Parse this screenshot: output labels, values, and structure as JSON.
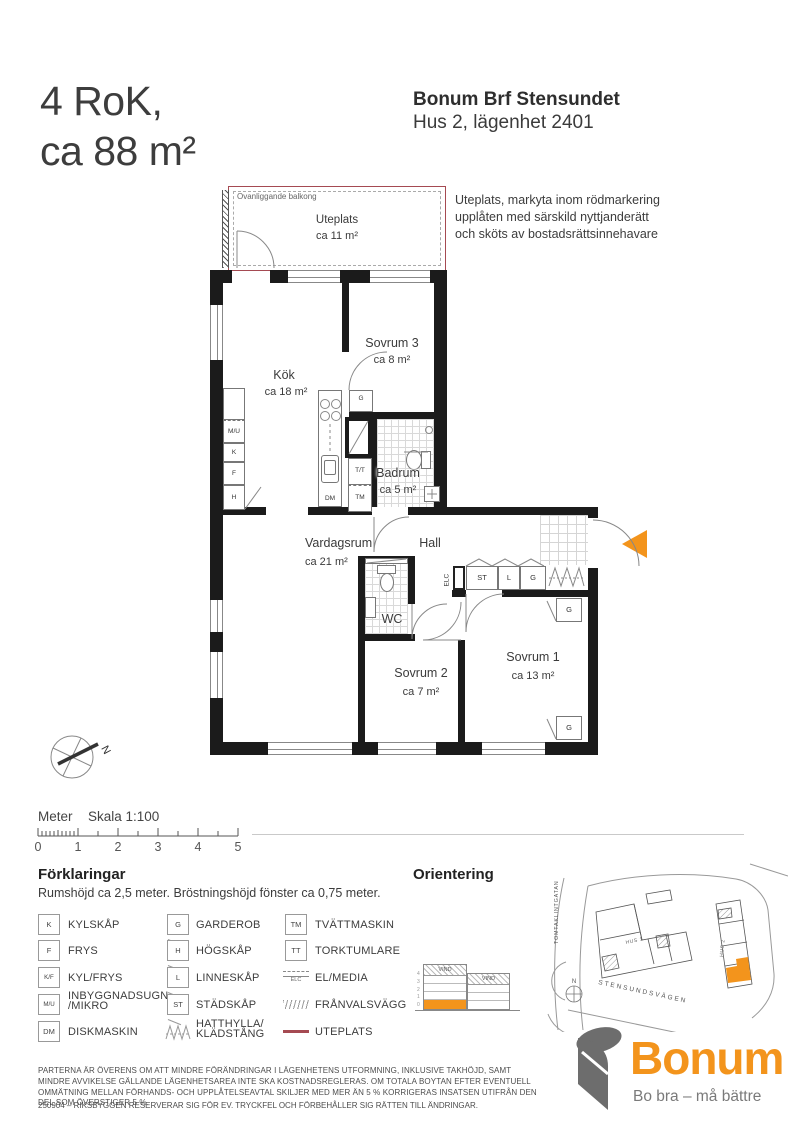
{
  "header": {
    "title_line1": "4 RoK,",
    "title_line2": "ca 88 m²",
    "project": "Bonum Brf Stensundet",
    "unit": "Hus 2, lägenhet 2401",
    "uteplats_note": "Uteplats, markyta inom rödmarkering upplåten med särskild nyttjanderätt och sköts av bostadsrättsinnehavare"
  },
  "plan": {
    "uteplats": {
      "overhead": "Ovanliggande balkong",
      "name": "Uteplats",
      "area": "ca 11 m²"
    },
    "rooms": {
      "kok": {
        "name": "Kök",
        "area": "ca 18 m²"
      },
      "sovrum3": {
        "name": "Sovrum 3",
        "area": "ca 8 m²"
      },
      "badrum": {
        "name": "Badrum",
        "area": "ca 5 m²"
      },
      "vardagsrum": {
        "name": "Vardagsrum",
        "area": "ca 21 m²"
      },
      "hall": {
        "name": "Hall"
      },
      "wc": {
        "name": "WC"
      },
      "sovrum2": {
        "name": "Sovrum 2",
        "area": "ca 7 m²"
      },
      "sovrum1": {
        "name": "Sovrum 1",
        "area": "ca 13 m²"
      }
    },
    "fixtures": {
      "mu": "M/U",
      "k": "K",
      "f": "F",
      "h": "H",
      "dm": "DM",
      "g": "G",
      "tt": "T/T",
      "tm": "TM",
      "elc": "ELC",
      "st": "ST",
      "l": "L"
    },
    "compass_label": "N"
  },
  "scalebar": {
    "unit": "Meter",
    "scale": "Skala 1:100",
    "ticks": [
      "0",
      "1",
      "2",
      "3",
      "4",
      "5"
    ]
  },
  "legend": {
    "heading": "Förklaringar",
    "subtitle": "Rumshöjd ca 2,5 meter. Bröstningshöjd fönster ca 0,75 meter.",
    "col1": [
      {
        "sym": "K",
        "label": "KYLSKÅP"
      },
      {
        "sym": "F",
        "label": "FRYS"
      },
      {
        "sym": "K/F",
        "label": "KYL/FRYS"
      },
      {
        "sym": "M/U",
        "label": "INBYGGNADSUGN /MIKRO"
      },
      {
        "sym": "DM",
        "label": "DISKMASKIN"
      }
    ],
    "col2": [
      {
        "sym": "G",
        "label": "GARDEROB"
      },
      {
        "sym": "H",
        "label": "HÖGSKÅP"
      },
      {
        "sym": "L",
        "label": "LINNESKÅP"
      },
      {
        "sym": "ST",
        "label": "STÄDSKÅP"
      },
      {
        "sym": "",
        "label": "HATTHYLLA/ KLÄDSTÅNG"
      }
    ],
    "col3": [
      {
        "sym": "TM",
        "label": "TVÄTTMASKIN"
      },
      {
        "sym": "TT",
        "label": "TORKTUMLARE"
      },
      {
        "sym": "ELC",
        "label": "EL/MEDIA"
      },
      {
        "sym": "",
        "label": "FRÅNVALSVÄGG"
      },
      {
        "sym": "",
        "label": "UTEPLATS"
      }
    ]
  },
  "orientation": {
    "heading": "Orientering",
    "vind": "VIND",
    "floor_numbers": "4\n3\n2\n1\n0",
    "streets": {
      "left": "TOMTAKLINTGATAN",
      "bottom": "STENSUNDSVÄGEN"
    },
    "buildings": {
      "hus1": "HUS 1",
      "hus2": "HUS 2"
    },
    "compass": "N"
  },
  "footer": {
    "legal": "PARTERNA ÄR ÖVERENS OM ATT MINDRE FÖRÄNDRINGAR I LÄGENHETENS UTFORMNING, INKLUSIVE TAKHÖJD, SAMT MINDRE AVVIKELSE GÄLLANDE LÄGENHETSAREA INTE SKA KOSTNADSREGLERAS. OM TOTALA BOYTAN EFTER EVENTUELL OMMÄTNING MELLAN FÖRHANDS- OCH UPPLÅTELSEAVTAL SKILJER MED MER ÄN 5 % KORRIGERAS INSATSEN UTIFRÅN DEN DEL SOM ÖVERSTIGER 5 %.",
    "revision": "250904 – RIKSBYGGEN RESERVERAR SIG FÖR EV. TRYCKFEL OCH FÖRBEHÅLLER SIG RÄTTEN TILL ÄNDRINGAR."
  },
  "brand": {
    "name": "Bonum",
    "tagline": "Bo bra – må bättre"
  },
  "colors": {
    "accent_orange": "#F3941C",
    "uteplats_red": "#A54A52",
    "wall_black": "#1B1B1B"
  }
}
